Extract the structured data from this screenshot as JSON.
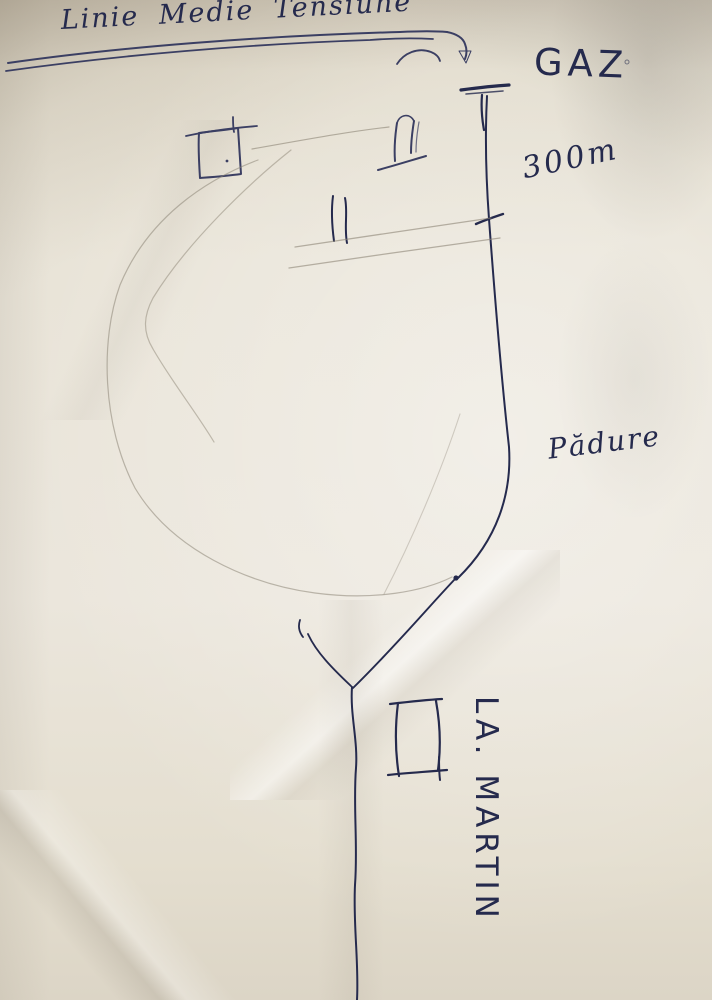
{
  "colors": {
    "paper": "#e9e4d8",
    "ink_dark": "#252a4d",
    "ink_medium": "#3b3f63",
    "pencil": "#8d8576"
  },
  "labels": {
    "power_line": "Linie Medie Tensiune",
    "gas_station": "GAZ",
    "distance": "300m",
    "forest": "Pădure",
    "destination": "LA. MARTIN"
  }
}
